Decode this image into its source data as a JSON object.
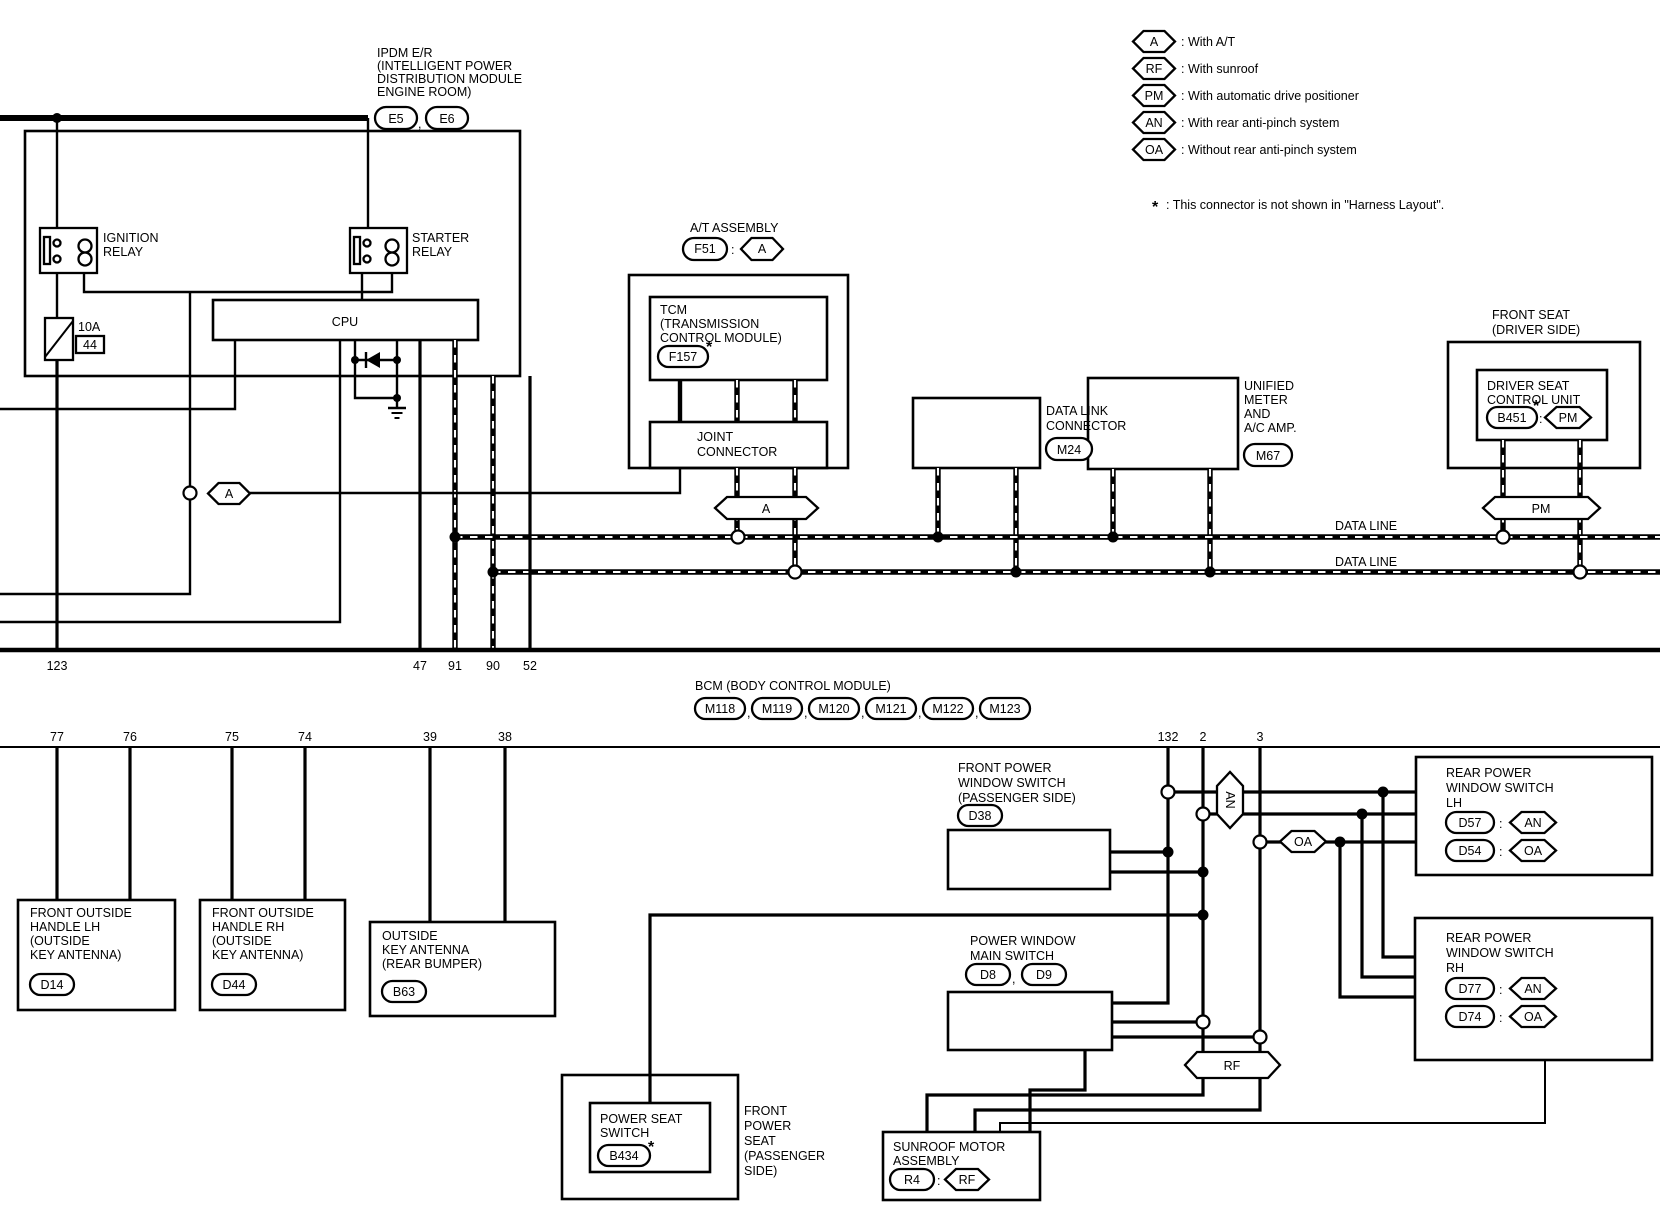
{
  "legend": {
    "items": [
      {
        "code": "A",
        "desc": ": With A/T"
      },
      {
        "code": "RF",
        "desc": ": With sunroof"
      },
      {
        "code": "PM",
        "desc": ": With automatic drive positioner"
      },
      {
        "code": "AN",
        "desc": ": With rear anti-pinch system"
      },
      {
        "code": "OA",
        "desc": ": Without rear anti-pinch system"
      }
    ],
    "star": "*",
    "note": ": This connector is not shown in \"Harness Layout\"."
  },
  "ipdm": {
    "t1": "IPDM E/R",
    "t2": "(INTELLIGENT POWER",
    "t3": "DISTRIBUTION MODULE",
    "t4": "ENGINE ROOM)",
    "e5": "E5",
    "comma": ",",
    "e6": "E6",
    "ign1": "IGNITION",
    "ign2": "RELAY",
    "str1": "STARTER",
    "str2": "RELAY",
    "cpu": "CPU",
    "fuse": "10A",
    "fuse_no": "44"
  },
  "pins": {
    "p123": "123",
    "p47": "47",
    "p91": "91",
    "p90": "90",
    "p52": "52",
    "p77": "77",
    "p76": "76",
    "p75": "75",
    "p74": "74",
    "p39": "39",
    "p38": "38",
    "p132": "132",
    "p2": "2",
    "p3": "3"
  },
  "bcm": {
    "title": "BCM (BODY CONTROL MODULE)",
    "comma": ",",
    "c": [
      "M118",
      "M119",
      "M120",
      "M121",
      "M122",
      "M123"
    ]
  },
  "at": {
    "title": "A/T ASSEMBLY",
    "f51": "F51",
    "colon": ":",
    "a": "A",
    "tcm1": "TCM",
    "tcm2": "(TRANSMISSION",
    "tcm3": "CONTROL MODULE)",
    "f157": "F157",
    "star": "*",
    "jc1": "JOINT",
    "jc2": "CONNECTOR",
    "ahex": "A",
    "ahex2": "A"
  },
  "dlc": {
    "l1": "DATA LINK",
    "l2": "CONNECTOR",
    "m24": "M24"
  },
  "meter": {
    "l1": "UNIFIED",
    "l2": "METER",
    "l3": "AND",
    "l4": "A/C AMP.",
    "m67": "M67"
  },
  "seat": {
    "t1": "FRONT SEAT",
    "t2": "(DRIVER SIDE)",
    "u1": "DRIVER SEAT",
    "u2": "CONTROL UNIT",
    "b451": "B451",
    "star": "*",
    "colon": ":",
    "pm": "PM",
    "pmhex": "PM"
  },
  "dataline": {
    "l1": "DATA LINE",
    "l2": "DATA LINE"
  },
  "lh": {
    "l1": "FRONT OUTSIDE",
    "l2": "HANDLE LH",
    "l3": "(OUTSIDE",
    "l4": "KEY ANTENNA)",
    "d14": "D14"
  },
  "rh": {
    "l1": "FRONT OUTSIDE",
    "l2": "HANDLE RH",
    "l3": "(OUTSIDE",
    "l4": "KEY ANTENNA)",
    "d44": "D44"
  },
  "oka": {
    "l1": "OUTSIDE",
    "l2": "KEY ANTENNA",
    "l3": "(REAR BUMPER)",
    "b63": "B63"
  },
  "fpws": {
    "l1": "FRONT POWER",
    "l2": "WINDOW SWITCH",
    "l3": "(PASSENGER SIDE)",
    "d38": "D38"
  },
  "anhex": "AN",
  "oahex": "OA",
  "rfhex": "RF",
  "rlh": {
    "l1": "REAR POWER",
    "l2": "WINDOW SWITCH",
    "l3": "LH",
    "d57": "D57",
    "d54": "D54",
    "an": "AN",
    "oa": "OA",
    "colon": ":"
  },
  "rrh": {
    "l1": "REAR POWER",
    "l2": "WINDOW SWITCH",
    "l3": "RH",
    "d77": "D77",
    "d74": "D74",
    "an": "AN",
    "oa": "OA",
    "colon": ":"
  },
  "pwms": {
    "l1": "POWER WINDOW",
    "l2": "MAIN SWITCH",
    "d8": "D8",
    "comma": ",",
    "d9": "D9"
  },
  "pss": {
    "l1": "POWER SEAT",
    "l2": "SWITCH",
    "b434": "B434",
    "star": "*",
    "s1": "FRONT",
    "s2": "POWER",
    "s3": "SEAT",
    "s4": "(PASSENGER",
    "s5": "SIDE)"
  },
  "sunroof": {
    "l1": "SUNROOF MOTOR",
    "l2": "ASSEMBLY",
    "r4": "R4",
    "colon": ":",
    "rf": "RF"
  }
}
